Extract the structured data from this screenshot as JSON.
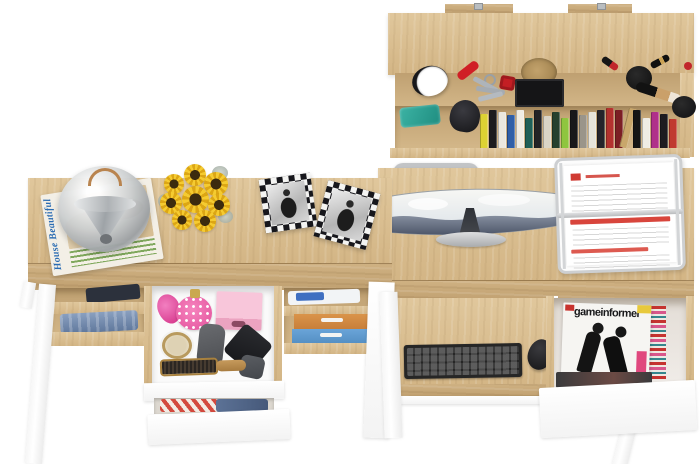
{
  "scene": {
    "description": "Top-down studio render of a matching home-office furniture set in light sonoma oak and white: a wall shelf with accessories and books, a dressing desk with open cosmetic and clothing drawers, and a computer desk with curved monitor, keyboard tray, document tray and an open magazine drawer.",
    "background": "#ffffff"
  },
  "palette": {
    "oak": "#d8bc8e",
    "oak_front": "#c9ab7c",
    "oak_interior": "#c2a476",
    "furniture_white": "#ffffff",
    "metal_silver": "#c9ccce",
    "accent_pink": "#f074b2",
    "accent_red": "#c8332e",
    "denim_blue": "#7089ad",
    "sunflower_yellow": "#f0c42a"
  },
  "texts": {
    "house_magazine_title": "House Beautiful",
    "game_magazine_title": "gameinformer"
  },
  "wall_shelf": {
    "label": "wall-mounted shelf",
    "items": [
      "alarm clock",
      "pocket knife",
      "keys with red fob",
      "cork basket on black tray",
      "makeup brushes",
      "powder puffs",
      "lipsticks",
      "teal case",
      "book row"
    ],
    "books": [
      {
        "c": "#ddd233",
        "h": 34
      },
      {
        "c": "#1c1c1e",
        "h": 38
      },
      {
        "c": "#ebe8df",
        "h": 36
      },
      {
        "c": "#2f5fa8",
        "h": 33
      },
      {
        "c": "#f0ede4",
        "h": 38
      },
      {
        "c": "#1f6057",
        "h": 30
      },
      {
        "c": "#232325",
        "h": 38
      },
      {
        "c": "#d9d4c6",
        "h": 32
      },
      {
        "c": "#25412e",
        "h": 36
      },
      {
        "c": "#8fc53f",
        "h": 30
      },
      {
        "c": "#18181a",
        "h": 38
      },
      {
        "c": "#9a958a",
        "h": 33
      },
      {
        "c": "#e7e4da",
        "h": 36
      },
      {
        "c": "#26242a",
        "h": 38
      },
      {
        "c": "#b4322e",
        "h": 40
      },
      {
        "c": "#7c1f24",
        "h": 38
      },
      {
        "c": "#c9a76b",
        "h": 40,
        "r": 14
      },
      {
        "c": "#151515",
        "h": 38
      },
      {
        "c": "#efece4",
        "h": 30
      },
      {
        "c": "#b0308a",
        "h": 36
      },
      {
        "c": "#1d1b20",
        "h": 34
      },
      {
        "c": "#c03a30",
        "h": 29
      }
    ]
  },
  "left_desk": {
    "label": "dressing desk",
    "top_items": [
      "chrome dome lamp",
      "House Beautiful magazine",
      "sunflower bouquet",
      "two checkered photo frames"
    ],
    "drawer_items": [
      "pink perfume atomizer",
      "pink box",
      "cream jar",
      "grey cases",
      "black pouch",
      "wooden hairbrush"
    ],
    "shelf_items": [
      "folded jeans",
      "dark clothing",
      "white-blue cloth",
      "orange box",
      "blue box"
    ],
    "lower_drawer_items": [
      "striped shirt",
      "jeans"
    ]
  },
  "right_desk": {
    "label": "computer desk",
    "top_items": [
      "curved monitor",
      "office chair",
      "wire document tray with papers"
    ],
    "tray_items": [
      "black keyboard",
      "black mouse"
    ],
    "drawer_items": [
      "gameinformer magazine",
      "magazine stack"
    ]
  }
}
